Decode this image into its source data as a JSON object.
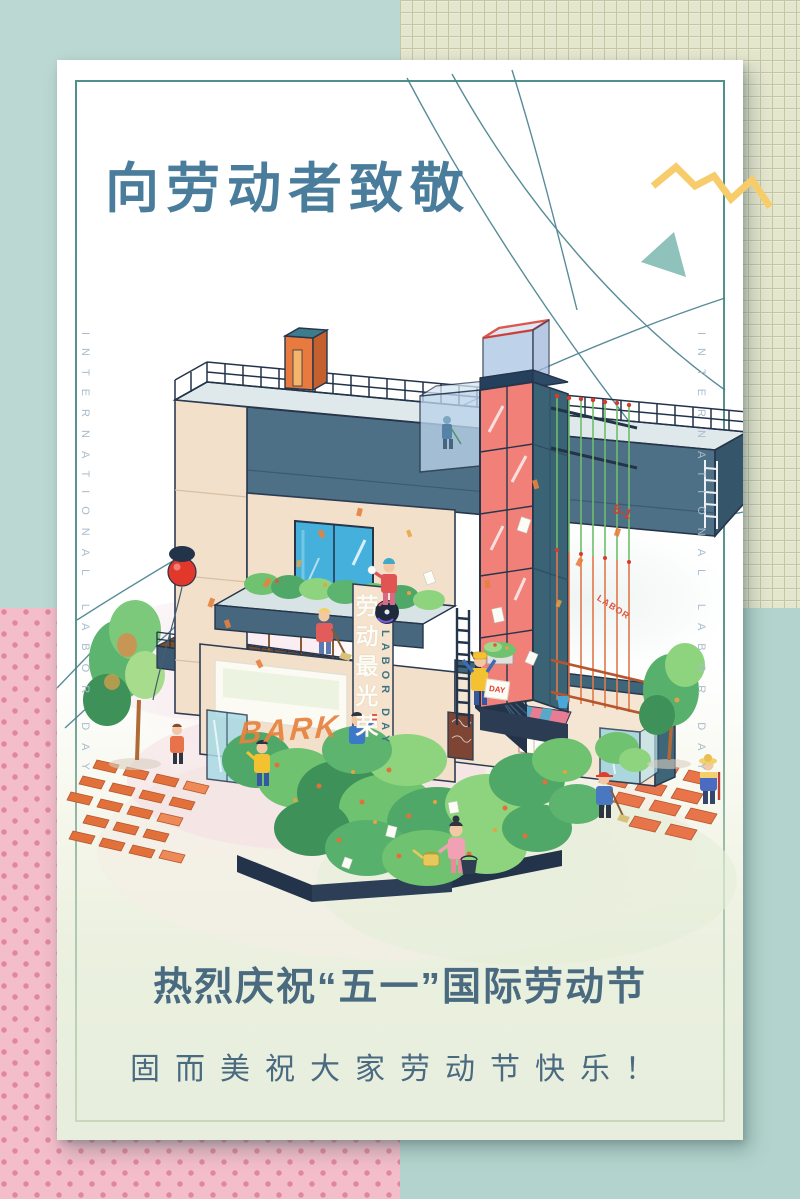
{
  "poster": {
    "title": "向劳动者致敬",
    "slogans": {
      "line1": "热烈庆祝“五一”国际劳动节",
      "line2": "固而美祝大家劳动节快乐！"
    },
    "margin_text": {
      "left": "INTERNATIONAL LABOR DAY",
      "right": "INTERNATIONAL LABOR DAY"
    },
    "illustration": {
      "theme": "isometric 51 building with workers and greenery",
      "building_sign_cn": "劳动最光荣",
      "building_sign_en": "LABOR DAY",
      "scaffold_tag": "5-1",
      "scaffold_tag_small": "LABOR",
      "graffiti_text": "BARK",
      "wall_note": "DAY"
    },
    "colors": {
      "mint_top_left": "#bcd8d2",
      "mint_bottom_right": "#b3d4ce",
      "grid_paper": "#e4e6ce",
      "pink_dots_bg": "#f3bdca",
      "pink_dot": "#e0879f",
      "title_text": "#4a7d9b",
      "slogan_text": "#4a6a80",
      "margin_text": "#a9bccb",
      "border_top": "#4f8f8e",
      "border_bottom": "#c9d8bc",
      "zigzag_yellow": "#f6cd6a",
      "triangle_teal": "#8ec2ba",
      "tower_coral": "#f08078",
      "building_peach": "#f2e0cb",
      "building_slate": "#4e7086",
      "outline_navy": "#26354a",
      "balloon_red": "#e2382c",
      "accent_red": "#d93a2e",
      "leaf_green": "#6fc26f",
      "brick_orange": "#e2703a"
    }
  }
}
